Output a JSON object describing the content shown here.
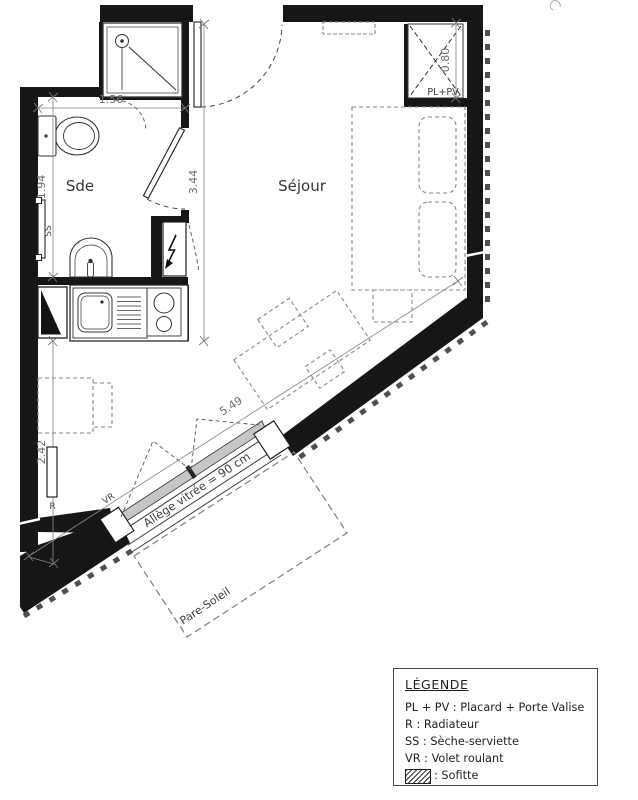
{
  "plan": {
    "room_labels": {
      "bathroom": "Sde",
      "living": "Séjour",
      "closet": "PL+PV"
    },
    "dimensions": {
      "bathroom_width_m": "1.56",
      "bathroom_length_m": "1.94",
      "entry_wall_length_m": "3.44",
      "closet_depth_m": "0.80",
      "lower_left_wall_m": "2.42",
      "glazed_facade_m": "5.49"
    },
    "equipment_labels": {
      "towel_dryer": "SS",
      "radiator": "R",
      "roller_shutter": "VR"
    },
    "annotations": {
      "window_sill": "Allège vitrée = 90 cm",
      "sun_shade": "Pare-Soleil"
    }
  },
  "legend": {
    "title": "LÉGENDE",
    "items": [
      "PL + PV : Placard + Porte Valise",
      "R : Radiateur",
      "SS : Sèche-serviette",
      "VR : Volet roulant"
    ],
    "hatch_item_label": ": Sofitte"
  }
}
